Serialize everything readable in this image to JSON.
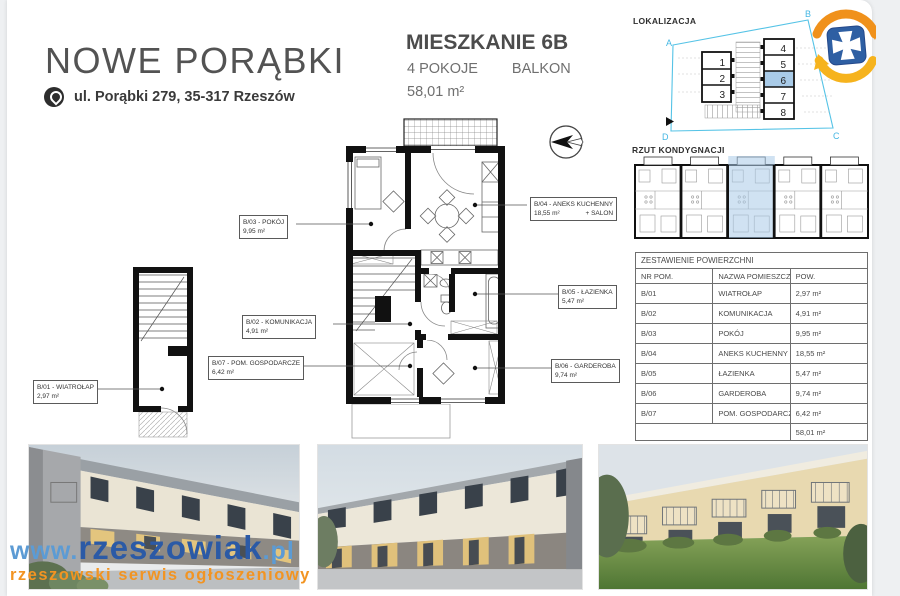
{
  "page": {
    "title": "NOWE PORĄBKI",
    "address": "ul. Porąbki 279, 35-317 Rzeszów"
  },
  "unit": {
    "name": "MIESZKANIE 6B",
    "rooms": "4 POKOJE",
    "extra": "BALKON",
    "area": "58,01 m²"
  },
  "lokalizacja": {
    "title": "LOKALIZACJA",
    "corner_a": "A",
    "corner_b": "B",
    "corner_c": "C",
    "corner_d": "D",
    "left_units": [
      "1",
      "2",
      "3"
    ],
    "right_units": [
      "4",
      "5",
      "6",
      "7",
      "8"
    ],
    "highlighted_unit": "6"
  },
  "rzut": {
    "title": "RZUT KONDYGNACJI"
  },
  "table": {
    "title": "ZESTAWIENIE POWIERZCHNI",
    "columns": [
      "NR POM.",
      "NAZWA POMIESZCZENIA",
      "POW."
    ],
    "rows": [
      [
        "B/01",
        "WIATROŁAP",
        "2,97 m²"
      ],
      [
        "B/02",
        "KOMUNIKACJA",
        "4,91 m²"
      ],
      [
        "B/03",
        "POKÓJ",
        "9,95 m²"
      ],
      [
        "B/04",
        "ANEKS KUCHENNY + SALON",
        "18,55 m²"
      ],
      [
        "B/05",
        "ŁAZIENKA",
        "5,47 m²"
      ],
      [
        "B/06",
        "GARDEROBA",
        "9,74 m²"
      ],
      [
        "B/07",
        "POM. GOSPODARCZE",
        "6,42 m²"
      ]
    ],
    "total": "58,01 m²"
  },
  "plan_labels": {
    "b01": {
      "name": "B/01 - WIATROŁAP",
      "area": "2,97 m²"
    },
    "b02": {
      "name": "B/02 - KOMUNIKACJA",
      "area": "4,91 m²"
    },
    "b03": {
      "name": "B/03 - POKÓJ",
      "area": "9,95 m²"
    },
    "b04": {
      "name": "B/04 - ANEKS KUCHENNY",
      "area": "18,55 m²",
      "name2": "+ SALON"
    },
    "b05": {
      "name": "B/05 - ŁAZIENKA",
      "area": "5,47 m²"
    },
    "b06": {
      "name": "B/06 - GARDEROBA",
      "area": "9,74 m²"
    },
    "b07": {
      "name": "B/07 - POM. GOSPODARCZE",
      "area": "6,42 m²"
    }
  },
  "watermark": {
    "prefix": "www.",
    "brand": "rzeszowiak",
    "suffix": ".pl",
    "tagline": "rzeszowski serwis ogłoszeniowy"
  },
  "colors": {
    "highlight_blue": "#a9cbe8",
    "site_outline_cyan": "#55c3e6",
    "brand_blue": "#2b5aa6",
    "brand_light_blue": "#5c9bd4",
    "brand_orange": "#f29422",
    "logo_blue": "#2e5fa3",
    "logo_orange": "#f0911b"
  }
}
